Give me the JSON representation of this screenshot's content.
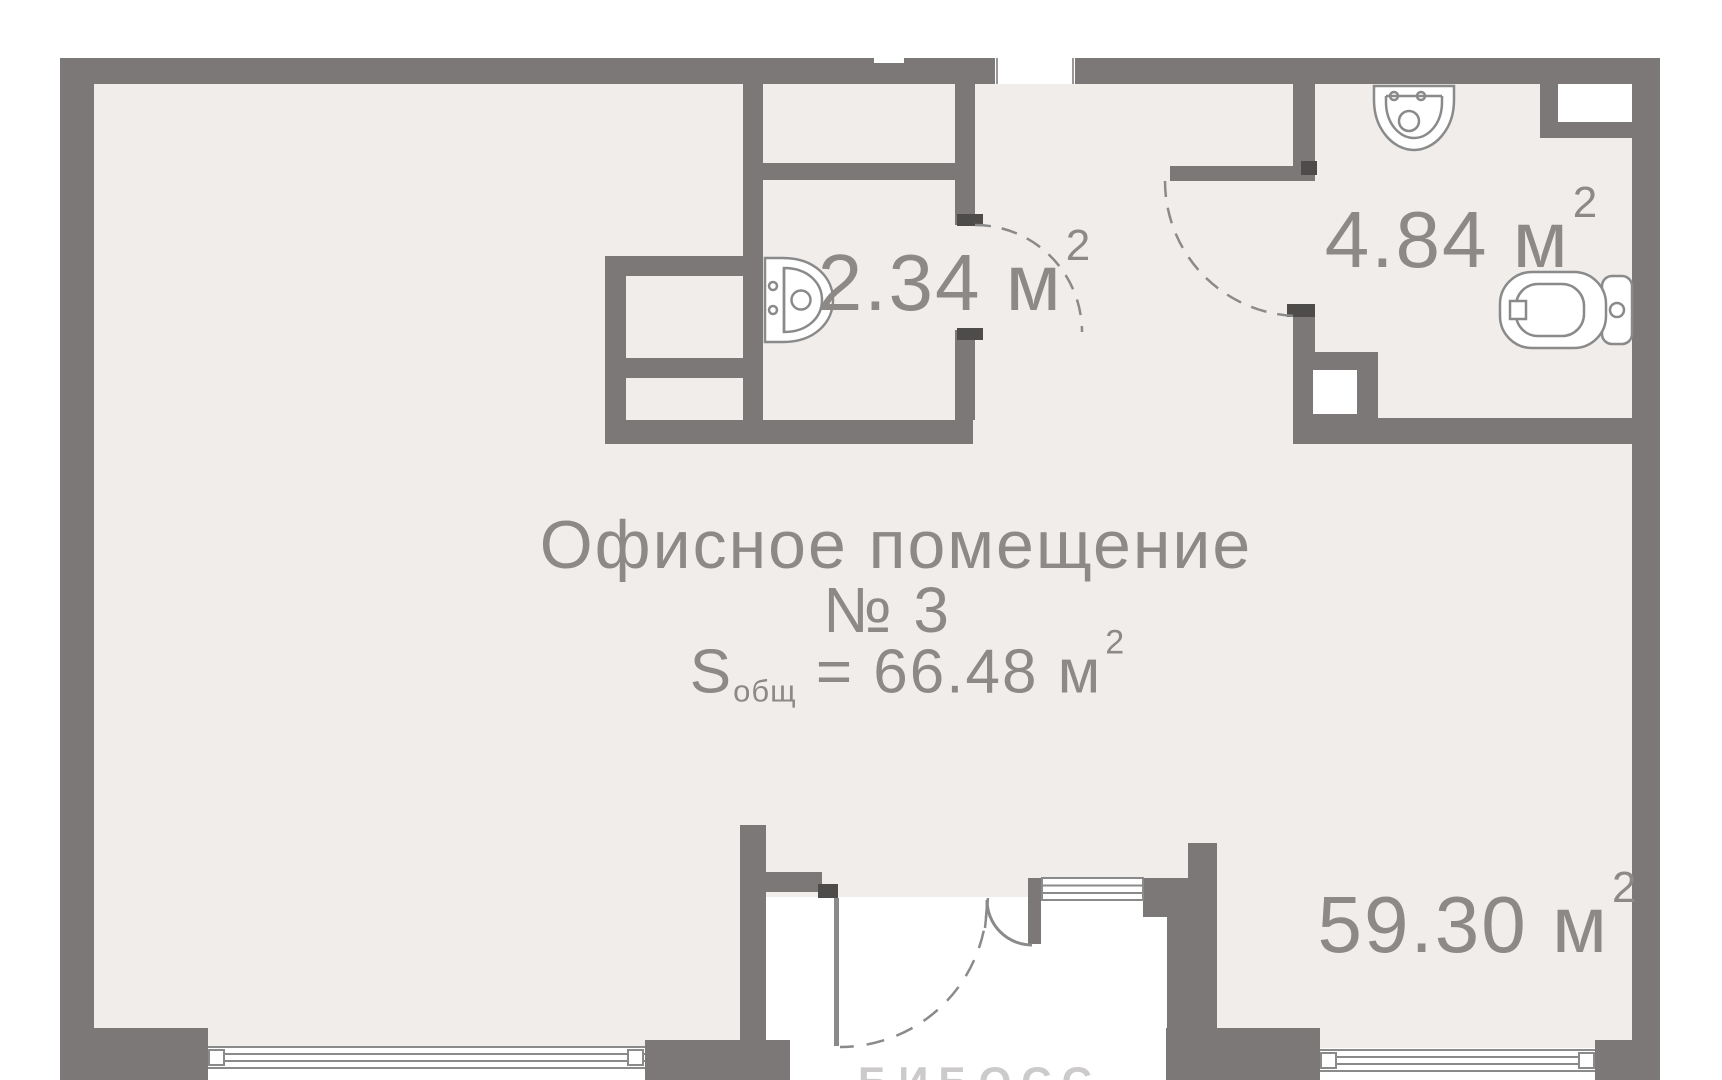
{
  "plan": {
    "main_room": {
      "title_line1": "Офисное помещение",
      "title_line2": "№ 3",
      "area_symbol": "S",
      "area_subscript": "общ",
      "area_value": "= 66.48 м",
      "area_sup": "2"
    },
    "room_labels": {
      "small_bathroom": {
        "text": "2.34 м",
        "sup": "2"
      },
      "large_bathroom": {
        "text": "4.84 м",
        "sup": "2"
      },
      "main_open_space": {
        "text": "59.30 м",
        "sup": "2"
      }
    },
    "watermark": "БИБОСС",
    "fixtures": [
      "sink-icon",
      "sink-icon",
      "toilet-icon"
    ],
    "colors": {
      "wall": "#7b7877",
      "floor": "#f0edea",
      "label_text": "#8d8987",
      "line": "#8a8a8a",
      "jamb_tick": "#4e4c4b",
      "background": "#ffffff"
    }
  }
}
